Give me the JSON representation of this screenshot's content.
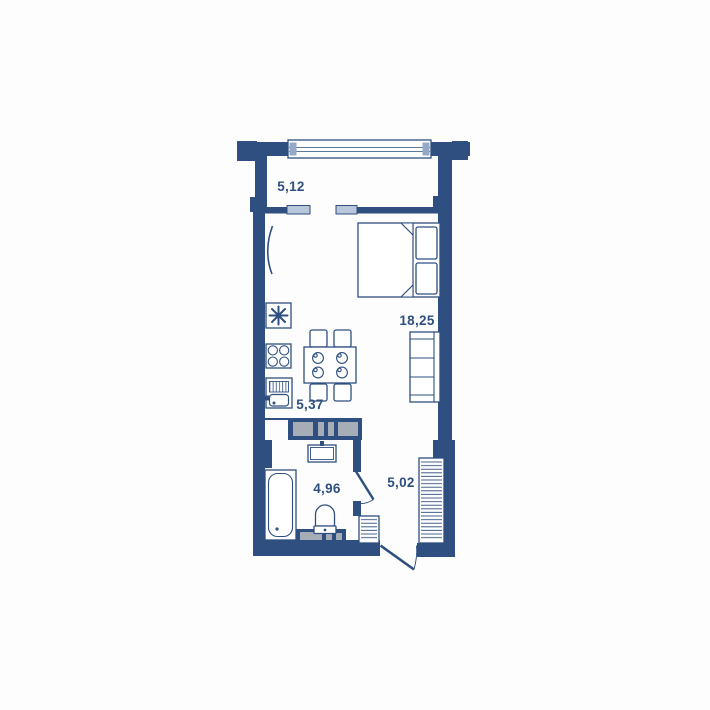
{
  "plan": {
    "type": "apartment-floor-plan",
    "rooms": {
      "balcony": {
        "area_label": "5,12"
      },
      "living_room": {
        "area_label": "18,25"
      },
      "kitchen": {
        "area_label": "5,37"
      },
      "bathroom": {
        "area_label": "4,96"
      },
      "hallway": {
        "area_label": "5,02"
      }
    },
    "colors": {
      "wall": "#2e4f7f",
      "label": "#2e4f7f",
      "window_fill": "#b8c7da",
      "window_cap": "#93a9c6",
      "shaft_panel": "#a7adb6",
      "background": "#fdfdfd"
    }
  }
}
